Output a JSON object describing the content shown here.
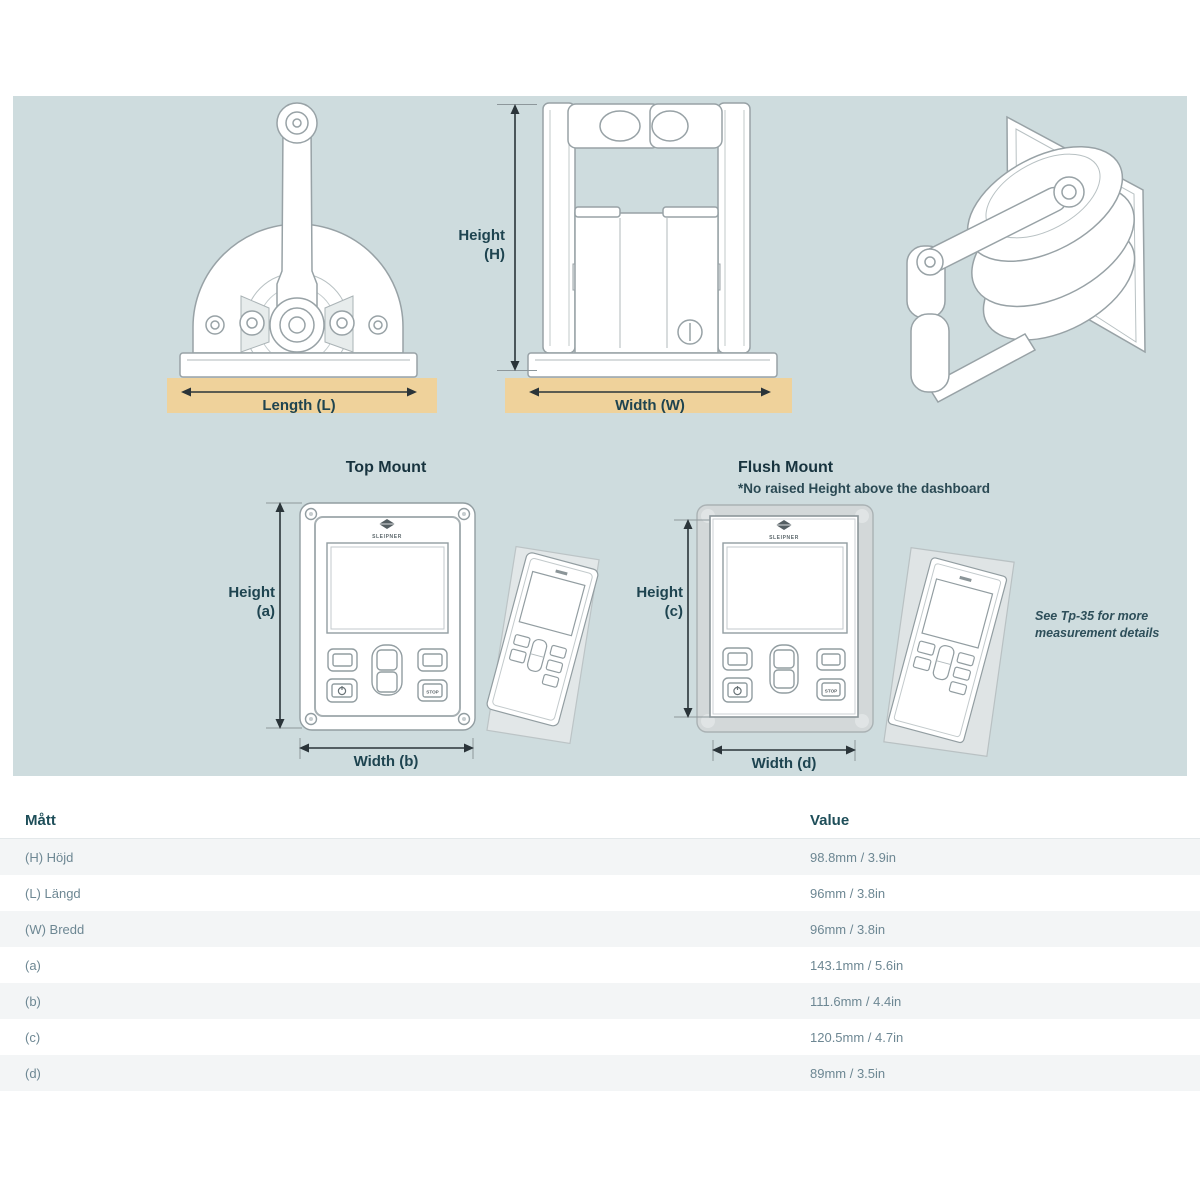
{
  "diagram": {
    "orthographic": {
      "height_label": [
        "Height",
        "(H)"
      ],
      "length_label": "Length (L)",
      "width_label": "Width (W)"
    },
    "top_mount": {
      "title": "Top Mount",
      "height_label": [
        "Height",
        "(a)"
      ],
      "width_label": "Width (b)",
      "brand": "SLEIPNER",
      "stop_button": "STOP"
    },
    "flush_mount": {
      "title": "Flush Mount",
      "subtitle": "*No raised Height above the dashboard",
      "height_label": [
        "Height",
        "(c)"
      ],
      "width_label": "Width (d)",
      "brand": "SLEIPNER",
      "stop_button": "STOP"
    },
    "note": [
      "See Tp-35 for more",
      "measurement details"
    ],
    "colors": {
      "panel_background": "#cedcde",
      "mounting_surface": "#efd29b",
      "dimension_line": "#2a3439",
      "label_text": "#1e4450",
      "drawing_line": "#98a2a6"
    }
  },
  "table": {
    "columns": [
      "Mått",
      "Value"
    ],
    "rows": [
      {
        "label": "(H) Höjd",
        "value": "98.8mm / 3.9in"
      },
      {
        "label": "(L) Längd",
        "value": "96mm / 3.8in"
      },
      {
        "label": "(W) Bredd",
        "value": "96mm / 3.8in"
      },
      {
        "label": "(a)",
        "value": "143.1mm / 5.6in"
      },
      {
        "label": "(b)",
        "value": "111.6mm / 4.4in"
      },
      {
        "label": "(c)",
        "value": "120.5mm / 4.7in"
      },
      {
        "label": "(d)",
        "value": "89mm / 3.5in"
      }
    ]
  }
}
